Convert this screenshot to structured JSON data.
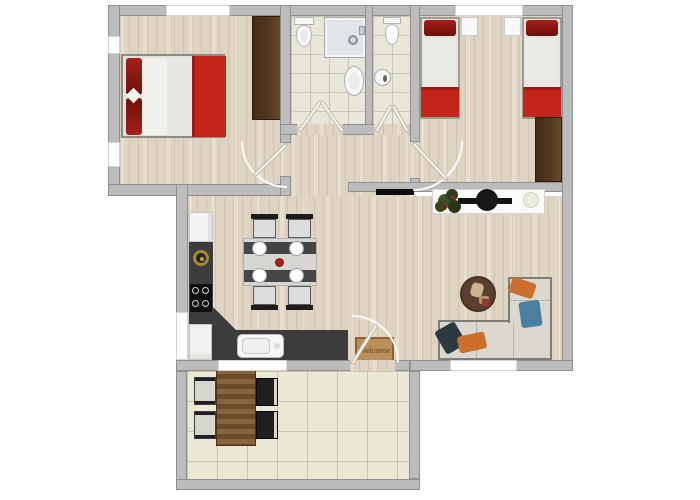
{
  "labels": {
    "doormat": "Welcome"
  },
  "colors": {
    "wall": "#bcbcbc",
    "wall_edge": "#8f8f8f",
    "wood_floor": "#ded4c1",
    "bath_tile": "#e9e6da",
    "terrace_tile": "#ebe8d5",
    "accent_red": "#c3251b",
    "dark_red": "#8e1410",
    "wardrobe_brown": "#523720",
    "counter_dark": "#3c3c3c",
    "sofa_beige": "#dbd8cf",
    "terrace_wood": "#75522f",
    "pillow_orange": "#cc6f2d",
    "pillow_blue": "#49809f",
    "pillow_navy": "#2c3a42",
    "tv_black": "#141414",
    "gold": "#a8872e",
    "mat_brown": "#b9905a"
  }
}
